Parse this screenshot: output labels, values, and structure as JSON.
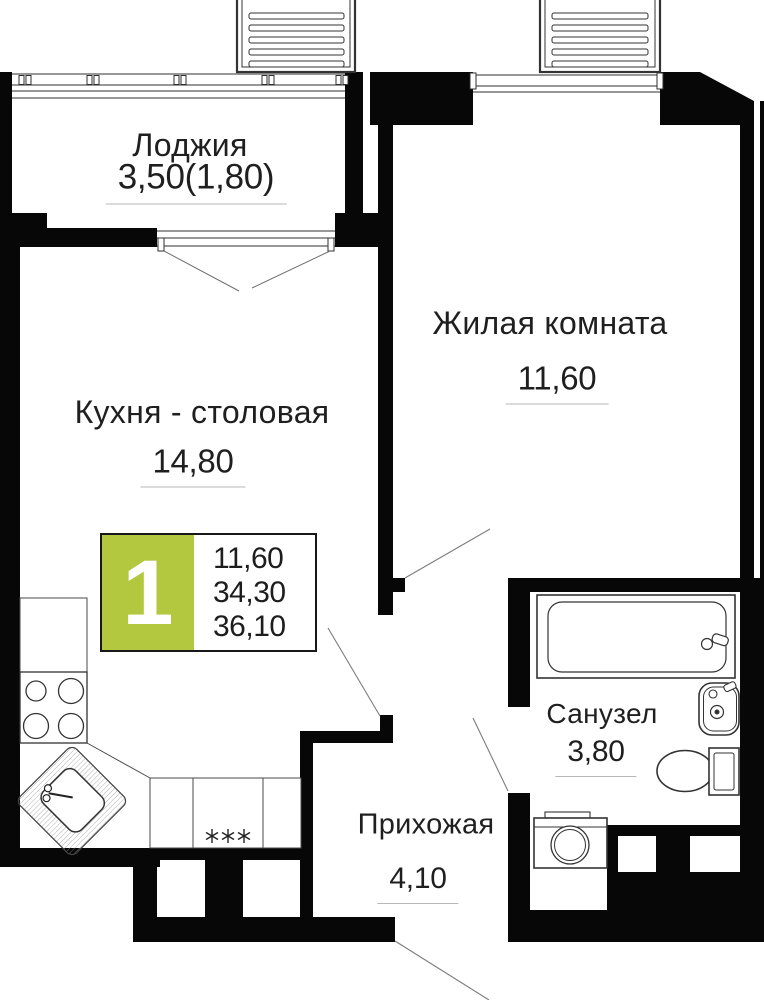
{
  "plan_title": "Floor plan of apartment unit",
  "info_badge": {
    "unit_number": "1",
    "values": [
      "11,60",
      "34,30",
      "36,10"
    ]
  },
  "rooms": {
    "loggia": {
      "name": "Лоджия",
      "area": "3,50(1,80)"
    },
    "living_room": {
      "name": "Жилая комната",
      "area": "11,60"
    },
    "kitchen": {
      "name": "Кухня - столовая",
      "area": "14,80"
    },
    "bathroom": {
      "name": "Санузел",
      "area": "3,80"
    },
    "hallway": {
      "name": "Прихожая",
      "area": "4,10"
    }
  },
  "colors": {
    "wall": "#070707",
    "accent_green": "#b4c83f",
    "leader_line": "#7d7d7d",
    "underline": "#b7b7b7"
  },
  "fixtures": [
    "stove-icon",
    "kitchen-corner-sink-icon",
    "kitchen-counter",
    "bathtub-icon",
    "wash-basin-icon",
    "toilet-icon",
    "washing-machine-icon",
    "ventilation-grille-icon",
    "ventilation-grille-icon"
  ]
}
